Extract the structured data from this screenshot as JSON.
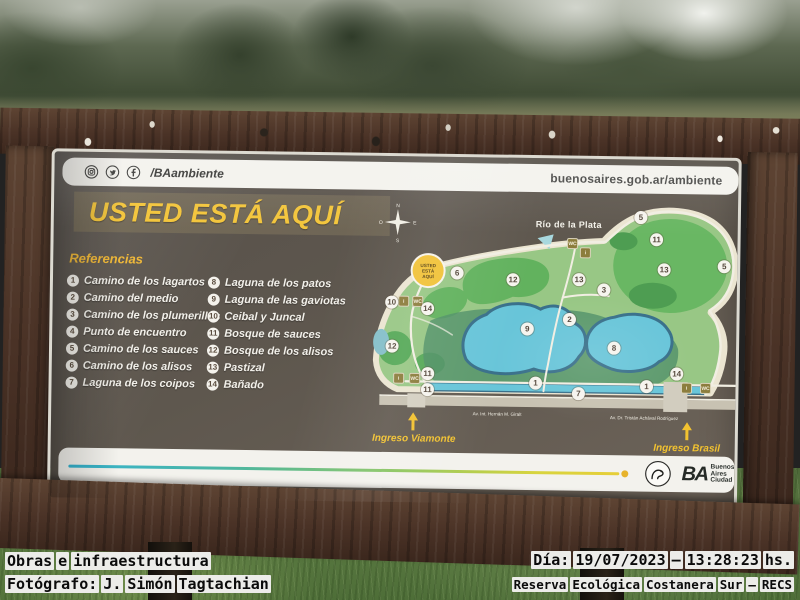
{
  "colors": {
    "accent_yellow": "#f2c230",
    "panel_brown": "#5d564c",
    "map_water": "#68c5d9",
    "map_green": "#98c785",
    "frame_wood": "#4a3226"
  },
  "photo": {
    "captions": {
      "left_line1": "Obras e infraestructura",
      "left_line2": "Fotógrafo: J. Simón Tagtachian",
      "right_line1": "Día: 19/07/2023 – 13:28:23 hs.",
      "right_line2": "Reserva Ecológica Costanera Sur – RECS"
    }
  },
  "sign": {
    "header": {
      "social_icons": [
        "instagram-icon",
        "twitter-icon",
        "facebook-icon"
      ],
      "social_handle": "/BAambiente",
      "website": "buenosaires.gob.ar/ambiente"
    },
    "title": "USTED ESTÁ AQUÍ",
    "referencias": {
      "heading": "Referencias",
      "col1": [
        {
          "n": "1",
          "label": "Camino de los lagartos"
        },
        {
          "n": "2",
          "label": "Camino del medio"
        },
        {
          "n": "3",
          "label": "Camino de los plumerillos"
        },
        {
          "n": "4",
          "label": "Punto de encuentro"
        },
        {
          "n": "5",
          "label": "Camino de los sauces"
        },
        {
          "n": "6",
          "label": "Camino de los alisos"
        },
        {
          "n": "7",
          "label": "Laguna de los coipos"
        }
      ],
      "col2": [
        {
          "n": "8",
          "label": "Laguna de los patos"
        },
        {
          "n": "9",
          "label": "Laguna de las gaviotas"
        },
        {
          "n": "10",
          "label": "Ceibal y Juncal"
        },
        {
          "n": "11",
          "label": "Bosque de sauces"
        },
        {
          "n": "12",
          "label": "Bosque de los alisos"
        },
        {
          "n": "13",
          "label": "Pastizal"
        },
        {
          "n": "14",
          "label": "Bañado"
        }
      ]
    },
    "map": {
      "river_label": "Río de la Plata",
      "compass": {
        "n": "N",
        "s": "S",
        "e": "E",
        "o": "O"
      },
      "you_are_here_lines": [
        "USTED",
        "ESTÁ",
        "AQUÍ"
      ],
      "road_left": "Av. Int. Hernán M. Giralt",
      "road_right": "Av. Dr. Tristán Achával Rodríguez",
      "entrance_left": "Ingreso Viamonte",
      "entrance_right": "Ingreso Brasil",
      "markers": [
        {
          "n": "6",
          "x": 88,
          "y": 72
        },
        {
          "n": "12",
          "x": 144,
          "y": 78
        },
        {
          "n": "13",
          "x": 210,
          "y": 77
        },
        {
          "n": "5",
          "x": 271,
          "y": 14
        },
        {
          "n": "11",
          "x": 287,
          "y": 36
        },
        {
          "n": "13",
          "x": 295,
          "y": 66
        },
        {
          "n": "5",
          "x": 355,
          "y": 62
        },
        {
          "n": "3",
          "x": 235,
          "y": 87
        },
        {
          "n": "2",
          "x": 201,
          "y": 117
        },
        {
          "n": "10",
          "x": 23,
          "y": 102
        },
        {
          "n": "14",
          "x": 59,
          "y": 108
        },
        {
          "n": "12",
          "x": 24,
          "y": 146
        },
        {
          "n": "9",
          "x": 159,
          "y": 127
        },
        {
          "n": "11",
          "x": 60,
          "y": 173
        },
        {
          "n": "11",
          "x": 60,
          "y": 189
        },
        {
          "n": "1",
          "x": 168,
          "y": 181
        },
        {
          "n": "7",
          "x": 211,
          "y": 191
        },
        {
          "n": "8",
          "x": 246,
          "y": 145
        },
        {
          "n": "14",
          "x": 309,
          "y": 170
        },
        {
          "n": "1",
          "x": 279,
          "y": 183
        }
      ],
      "facilities": [
        {
          "x": 35,
          "y": 101,
          "glyph": "i"
        },
        {
          "x": 49,
          "y": 101,
          "glyph": "WC"
        },
        {
          "x": 203,
          "y": 41,
          "glyph": "WC"
        },
        {
          "x": 216,
          "y": 50,
          "glyph": "i"
        },
        {
          "x": 31,
          "y": 178,
          "glyph": "i"
        },
        {
          "x": 47,
          "y": 178,
          "glyph": "WC"
        },
        {
          "x": 319,
          "y": 184,
          "glyph": "i"
        },
        {
          "x": 338,
          "y": 184,
          "glyph": "WC"
        }
      ]
    },
    "footer": {
      "ba_glyph": "BA",
      "ba_text": "Buenos\nAires\nCiudad"
    }
  }
}
